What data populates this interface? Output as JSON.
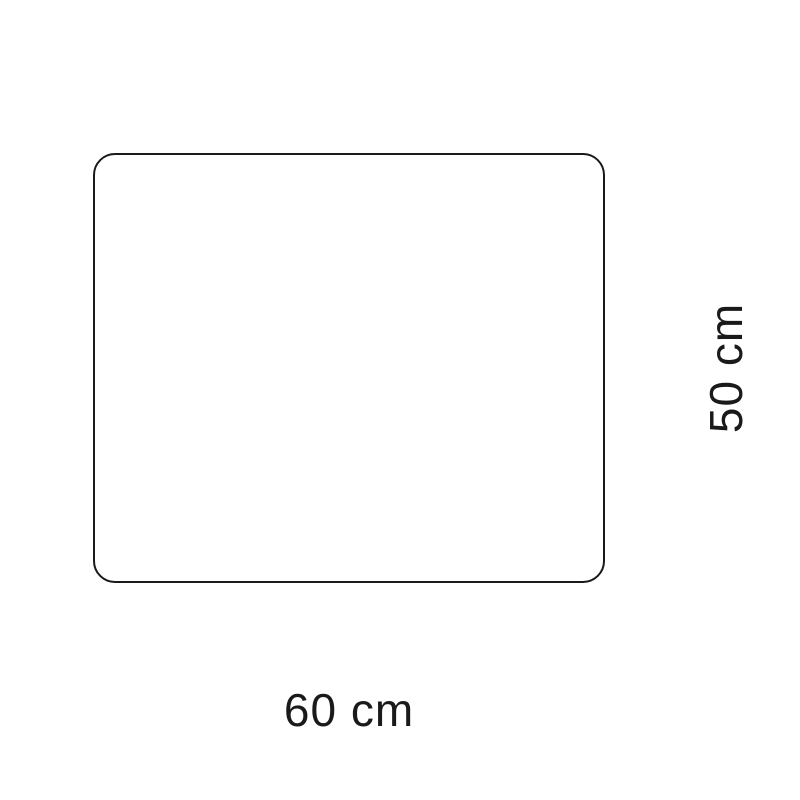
{
  "diagram": {
    "shape": "rounded-rectangle",
    "stroke_color": "#1a1a1a",
    "fill_color": "#ffffff",
    "background_color": "#ffffff",
    "width_label": "60 cm",
    "height_label": "50 cm",
    "width_value_cm": 60,
    "height_value_cm": 50
  }
}
